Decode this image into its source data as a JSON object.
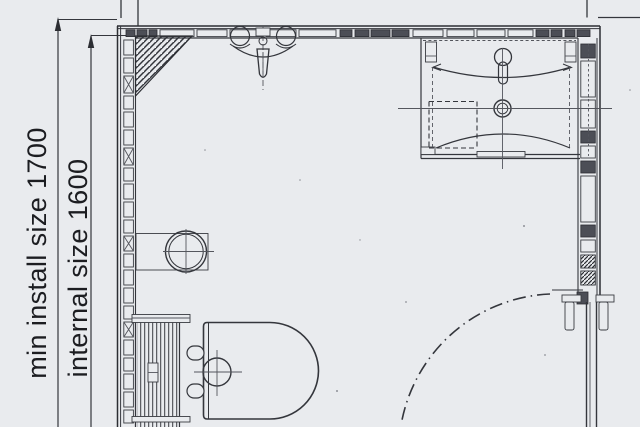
{
  "document": {
    "kind": "scanned bathroom floor plan drawing",
    "orientation": "plan view"
  },
  "labels": {
    "min_install_size": "min install size 1700",
    "internal_size": "internal size 1600"
  },
  "dimensions": {
    "min_install_mm": "1700",
    "internal_mm": "1600"
  },
  "fixtures": [
    "shower-mixer",
    "washbasin-unit",
    "floor-drain",
    "toilet-with-cistern",
    "door",
    "door-swing-arc",
    "corner-shelf-hatch"
  ],
  "colors": {
    "paper": "#e9ebee",
    "ink": "#34363c",
    "ink_soft": "#54565d",
    "panel_dark": "#4c4e56"
  }
}
